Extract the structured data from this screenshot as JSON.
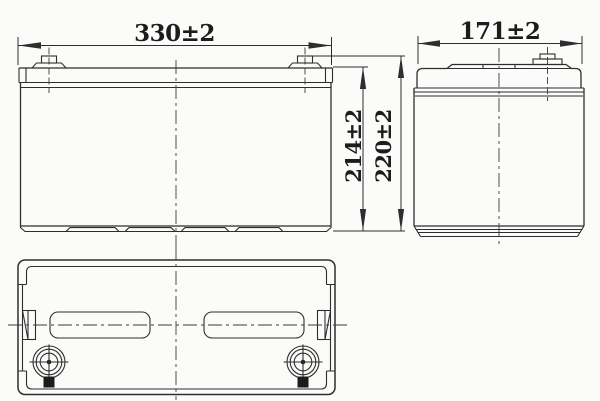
{
  "drawing": {
    "background_color": "#fbfbf9",
    "line_color": "#2e2e2e",
    "dimensions": {
      "front_width": "330±2",
      "side_width": "171±2",
      "case_height": "214±2",
      "total_height": "220±2"
    }
  }
}
